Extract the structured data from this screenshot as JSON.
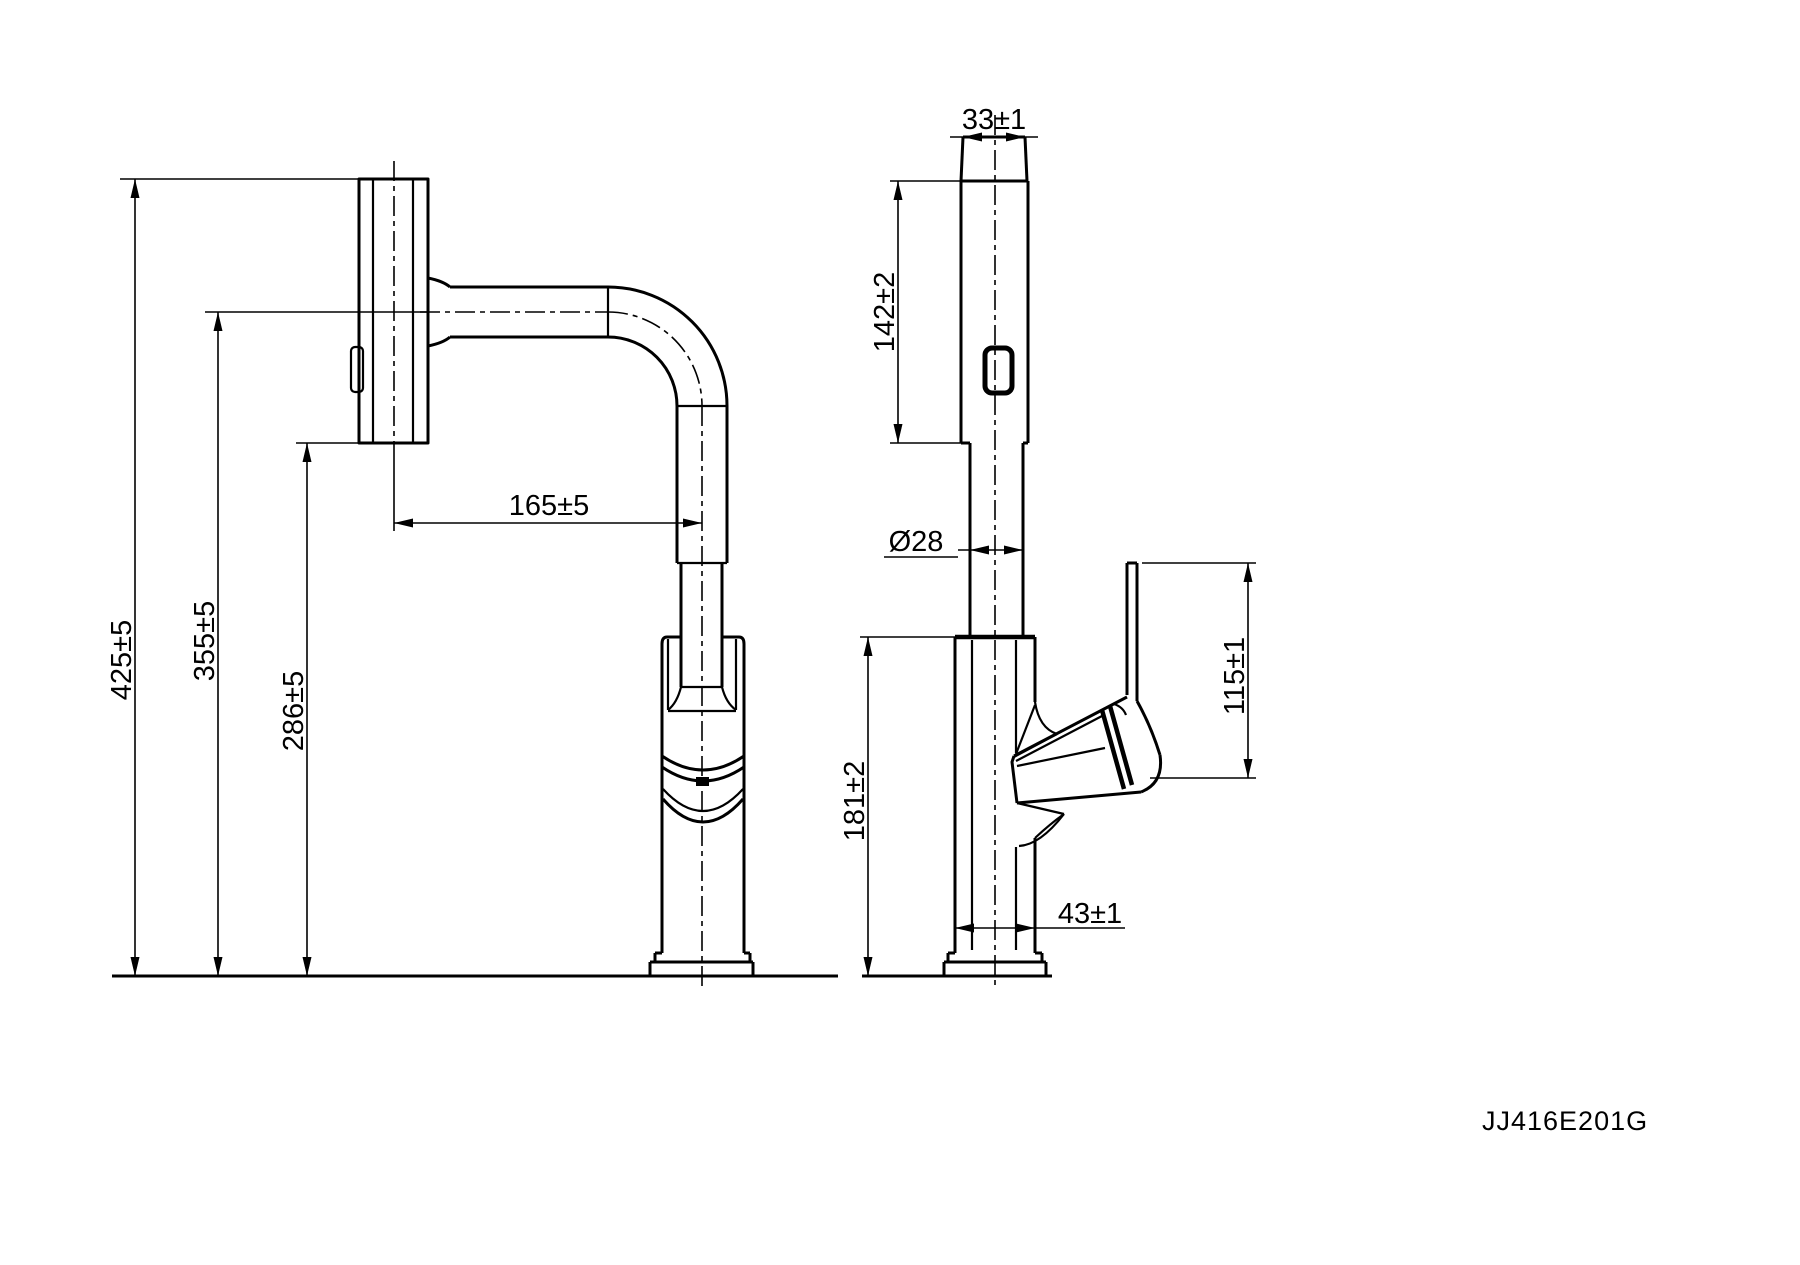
{
  "drawing": {
    "part_number": "JJ416E201G",
    "dimensions": {
      "total_height": "425±5",
      "spout_height": "355±5",
      "body_top_height": "286±5",
      "spout_reach": "165±5",
      "head_width": "33±1",
      "head_length": "142±2",
      "pipe_diameter": "Ø28",
      "mount_height": "181±2",
      "handle_height": "115±1",
      "base_diameter": "43±1"
    }
  }
}
